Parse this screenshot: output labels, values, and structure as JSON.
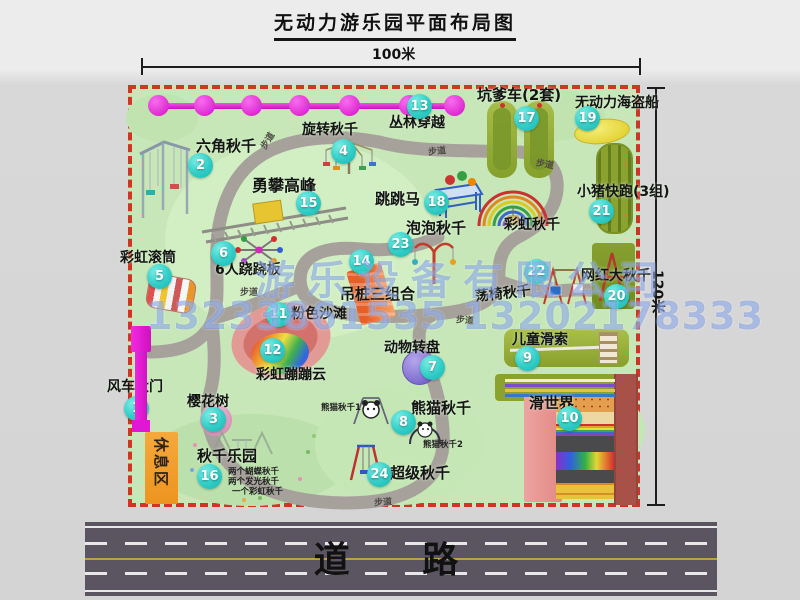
{
  "title": "无动力游乐园平面布局图",
  "dimension_top": "100米",
  "dimension_right": "120米",
  "road_label": "道 路",
  "path_label": "步道",
  "rest_area_label": "休息区",
  "watermark": {
    "company": "游乐设备有限公司",
    "phone": "13233861535 13202178333"
  },
  "colors": {
    "map_green": "#c7e7b8",
    "border_red": "#cd3524",
    "gate_magenta": "#e318d8",
    "badge_cyan": "#30cdc6",
    "road_gray": "#5a5560",
    "rest_orange": "#f0a032",
    "olive_green": "#8ba32e",
    "beach_pink": "#e29a94",
    "turntable_purple": "#8d7bd6",
    "ship_yellow": "#e8d838"
  },
  "attractions": [
    {
      "num": "1",
      "name": "风车大门"
    },
    {
      "num": "2",
      "name": "六角秋千"
    },
    {
      "num": "3",
      "name": "樱花树"
    },
    {
      "num": "4",
      "name": "旋转秋千"
    },
    {
      "num": "5",
      "name": "彩虹滚筒"
    },
    {
      "num": "6",
      "name": "6人跷跷板"
    },
    {
      "num": "7",
      "name": "动物转盘"
    },
    {
      "num": "8",
      "name": "熊猫秋千",
      "sub": [
        "熊猫秋千1",
        "熊猫秋千2"
      ]
    },
    {
      "num": "9",
      "name": "儿童滑索"
    },
    {
      "num": "10",
      "name": "滑世界"
    },
    {
      "num": "11",
      "name": "粉色沙滩"
    },
    {
      "num": "12",
      "name": "彩虹蹦蹦云"
    },
    {
      "num": "13",
      "name": "丛林穿越"
    },
    {
      "num": "14",
      "name": "吊桩三组合"
    },
    {
      "num": "15",
      "name": "勇攀高峰"
    },
    {
      "num": "16",
      "name": "秋千乐园",
      "details": [
        "两个蝴蝶秋千",
        "两个发光秋千",
        "一个彩虹秋千"
      ]
    },
    {
      "num": "17",
      "name": "坑爹车(2套)"
    },
    {
      "num": "18",
      "name": "跳跳马"
    },
    {
      "num": "19",
      "name": "无动力海盗船"
    },
    {
      "num": "20",
      "name": "网红大秋千"
    },
    {
      "num": "21",
      "name": "小猪快跑(3组)"
    },
    {
      "num": "22",
      "name": "荡椅秋千"
    },
    {
      "num": "23",
      "name": "泡泡秋千"
    },
    {
      "num": "24",
      "name": "超级秋千"
    },
    {
      "num": "",
      "name": "彩虹秋千"
    }
  ]
}
